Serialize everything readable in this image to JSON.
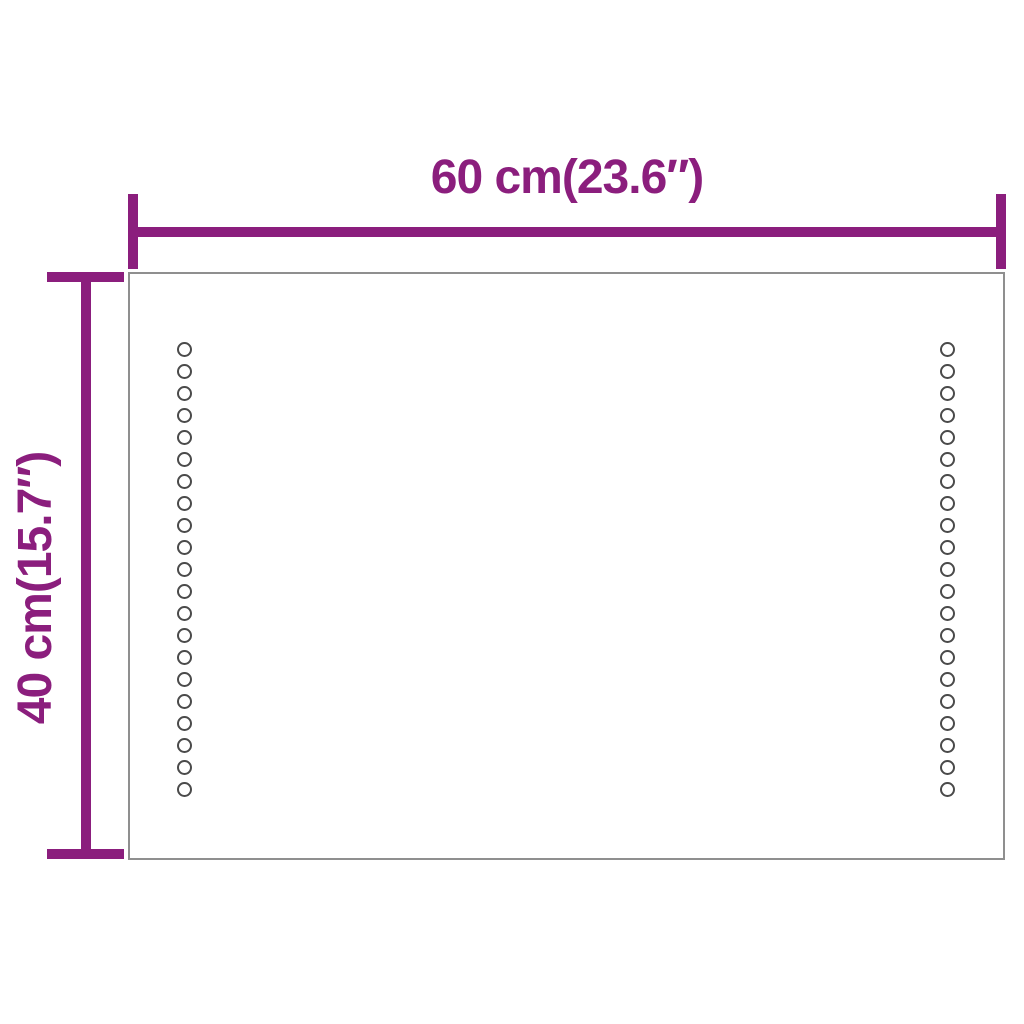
{
  "diagram": {
    "width_dimension": {
      "label": "60 cm(23.6″)"
    },
    "height_dimension": {
      "label": "40 cm(15.7″)"
    },
    "led_dots": {
      "columns": 2,
      "dots_per_column": 21
    },
    "colors": {
      "dimension_line": "#8b1e7d",
      "mirror_outline": "#8f8f8f",
      "led_dot_outline": "#4a4a4a",
      "background": "#ffffff"
    }
  }
}
